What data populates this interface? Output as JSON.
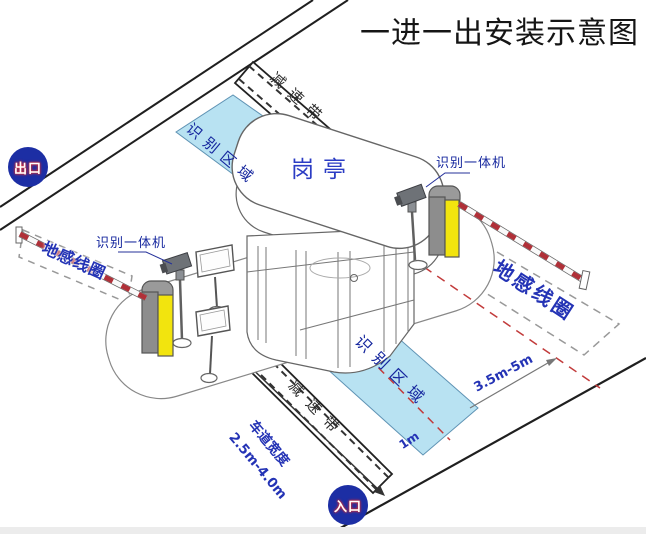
{
  "title": "一进一出安装示意图",
  "badges": {
    "exit": "出口",
    "entrance": "入口"
  },
  "booth": {
    "label": "岗亭"
  },
  "zones": {
    "recognition_top": "识别区域",
    "recognition_bottom": "识别区域",
    "speed_bump_top": "减速带",
    "speed_bump_bottom": "减速带",
    "ground_coil_left": "地感线圈",
    "ground_coil_right": "地感线圈"
  },
  "devices": {
    "camera_left": "识别一体机",
    "camera_right": "识别一体机"
  },
  "measurements": {
    "lane_width_label": "车道宽度",
    "lane_width_value": "2.5m-4.0m",
    "coil_distance": "3.5m-5m",
    "stop_line_offset": "1m"
  },
  "colors": {
    "zone_fill": "#b8e2f2",
    "badge_blue": "#1c2ea4",
    "label_navy": "#16279e",
    "measure_blue": "#2433b5",
    "barrier_red": "#b03038",
    "machine_yellow": "#f2e40e",
    "coil_dash_gray": "#999999",
    "lane_dash_red": "#c23b3b"
  }
}
